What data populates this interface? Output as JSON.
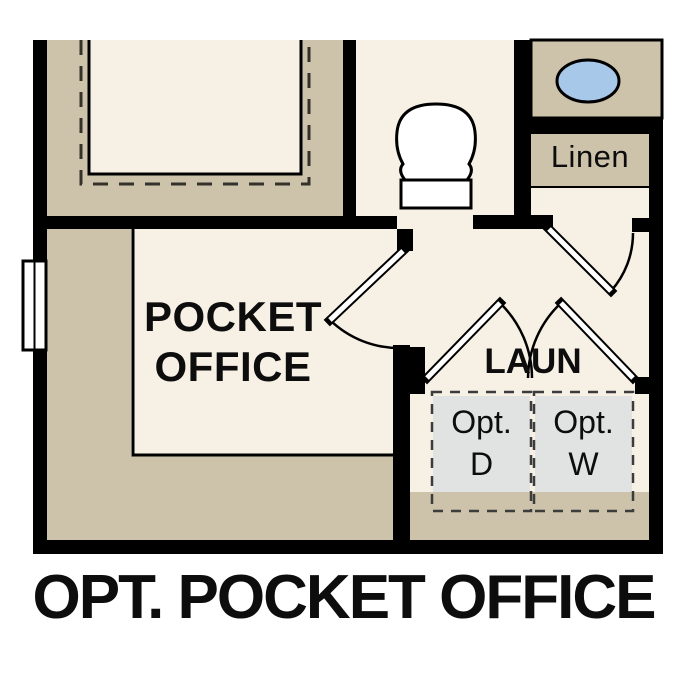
{
  "caption": "OPT. POCKET OFFICE",
  "rooms": {
    "pocket_office": {
      "name_line1": "POCKET",
      "name_line2": "OFFICE"
    },
    "laundry": {
      "name": "LAUN"
    },
    "linen": {
      "name": "Linen"
    }
  },
  "appliances": {
    "dryer": {
      "line1": "Opt.",
      "line2": "D"
    },
    "washer": {
      "line1": "Opt.",
      "line2": "W"
    }
  },
  "colors": {
    "wall": "#000000",
    "floor_shaded": "#cdc3aa",
    "floor_light": "#f7f0e4",
    "appliance_fill": "#e1e3e2",
    "sink_fill": "#a8c8e9",
    "background": "#ffffff"
  }
}
